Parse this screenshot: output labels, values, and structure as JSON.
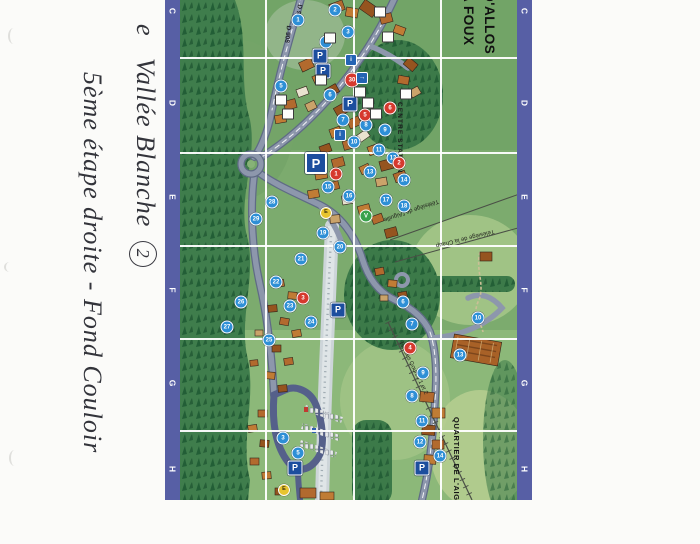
{
  "note": {
    "fragment": "e",
    "line1_prefix": "e",
    "line1_text": "Vallée Blanche",
    "line1_badge": "2",
    "line2_text": "5ème étape droite - Fond Couloir"
  },
  "map": {
    "title_line1": "D'ALLOS",
    "title_line2": "A FOUX",
    "grid_rows": [
      "C",
      "D",
      "E",
      "F",
      "G",
      "H"
    ],
    "road_label": "D 908",
    "labels": {
      "centre_station": "CENTRE STATION",
      "quartier_aiguille": "QUARTIER DE L'AIGUILLE",
      "lift_aiguille": "Télésiège de l'Aiguille",
      "lift_chaup": "Télésiège de la Chaup",
      "lift_goures": "Tsd des Gourès 1 et 2"
    },
    "colors": {
      "grid_strip": "#575fa5",
      "grid_line": "#ffffff",
      "meadow": "#7cab6e",
      "forest": "#2f6b3f",
      "road": "#8d97ac",
      "river": "#cdd5d9",
      "roof": "#b26a2e",
      "marker_blue": "#2e8fd6",
      "marker_red": "#d6392e",
      "parking_blue": "#1d4e9e"
    },
    "markers": [
      {
        "t": "p",
        "x": 140,
        "y": 56
      },
      {
        "t": "p",
        "x": 143,
        "y": 71
      },
      {
        "t": "pbig",
        "x": 136,
        "y": 163
      },
      {
        "t": "p",
        "x": 170,
        "y": 104
      },
      {
        "t": "p",
        "x": 158,
        "y": 310
      },
      {
        "t": "p",
        "x": 115,
        "y": 468
      },
      {
        "t": "p",
        "x": 242,
        "y": 468
      },
      {
        "t": "s30",
        "n": "30",
        "x": 172,
        "y": 80
      },
      {
        "t": "n",
        "n": "1",
        "x": 118,
        "y": 20
      },
      {
        "t": "n",
        "n": "2",
        "x": 155,
        "y": 10
      },
      {
        "t": "n",
        "n": "3",
        "x": 168,
        "y": 32
      },
      {
        "t": "n",
        "n": "4",
        "x": 146,
        "y": 42
      },
      {
        "t": "n",
        "n": "5",
        "x": 101,
        "y": 86
      },
      {
        "t": "n",
        "n": "6",
        "x": 150,
        "y": 95
      },
      {
        "t": "n",
        "n": "7",
        "x": 163,
        "y": 120
      },
      {
        "t": "n",
        "n": "8",
        "x": 186,
        "y": 125
      },
      {
        "t": "n",
        "n": "9",
        "x": 205,
        "y": 130
      },
      {
        "t": "n",
        "n": "10",
        "x": 174,
        "y": 142
      },
      {
        "t": "n",
        "n": "11",
        "x": 199,
        "y": 150
      },
      {
        "t": "n",
        "n": "12",
        "x": 213,
        "y": 158
      },
      {
        "t": "n",
        "n": "13",
        "x": 190,
        "y": 172
      },
      {
        "t": "n",
        "n": "14",
        "x": 224,
        "y": 180
      },
      {
        "t": "n",
        "n": "15",
        "x": 148,
        "y": 187
      },
      {
        "t": "n",
        "n": "16",
        "x": 169,
        "y": 196
      },
      {
        "t": "n",
        "n": "17",
        "x": 206,
        "y": 200
      },
      {
        "t": "n",
        "n": "18",
        "x": 224,
        "y": 206
      },
      {
        "t": "n",
        "n": "19",
        "x": 143,
        "y": 233
      },
      {
        "t": "n",
        "n": "20",
        "x": 160,
        "y": 247
      },
      {
        "t": "n",
        "n": "21",
        "x": 121,
        "y": 259
      },
      {
        "t": "n",
        "n": "22",
        "x": 96,
        "y": 282
      },
      {
        "t": "n",
        "n": "23",
        "x": 110,
        "y": 306
      },
      {
        "t": "n",
        "n": "24",
        "x": 131,
        "y": 322
      },
      {
        "t": "n",
        "n": "25",
        "x": 89,
        "y": 340
      },
      {
        "t": "n",
        "n": "26",
        "x": 61,
        "y": 302
      },
      {
        "t": "n",
        "n": "27",
        "x": 47,
        "y": 327
      },
      {
        "t": "n",
        "n": "28",
        "x": 92,
        "y": 202
      },
      {
        "t": "n",
        "n": "29",
        "x": 76,
        "y": 219
      },
      {
        "t": "n",
        "n": "6",
        "x": 223,
        "y": 302
      },
      {
        "t": "n",
        "n": "7",
        "x": 232,
        "y": 324
      },
      {
        "t": "n",
        "n": "10",
        "x": 298,
        "y": 318
      },
      {
        "t": "n",
        "n": "13",
        "x": 280,
        "y": 355
      },
      {
        "t": "n",
        "n": "9",
        "x": 243,
        "y": 373
      },
      {
        "t": "n",
        "n": "8",
        "x": 232,
        "y": 396
      },
      {
        "t": "n",
        "n": "11",
        "x": 242,
        "y": 421
      },
      {
        "t": "n",
        "n": "12",
        "x": 240,
        "y": 442
      },
      {
        "t": "n",
        "n": "14",
        "x": 260,
        "y": 456
      },
      {
        "t": "n",
        "n": "3",
        "x": 103,
        "y": 438
      },
      {
        "t": "n",
        "n": "5",
        "x": 118,
        "y": 453
      },
      {
        "t": "r",
        "n": "1",
        "x": 156,
        "y": 174
      },
      {
        "t": "r",
        "n": "2",
        "x": 219,
        "y": 163
      },
      {
        "t": "r",
        "n": "3",
        "x": 123,
        "y": 298
      },
      {
        "t": "r",
        "n": "4",
        "x": 230,
        "y": 348
      },
      {
        "t": "r",
        "n": "5",
        "x": 185,
        "y": 115
      },
      {
        "t": "r",
        "n": "6",
        "x": 210,
        "y": 108
      },
      {
        "t": "y",
        "n": "E",
        "x": 146,
        "y": 213
      },
      {
        "t": "y",
        "n": "E",
        "x": 104,
        "y": 490
      },
      {
        "t": "g",
        "n": "V",
        "x": 186,
        "y": 216
      },
      {
        "t": "ws",
        "x": 101,
        "y": 100
      },
      {
        "t": "ws",
        "x": 108,
        "y": 114
      },
      {
        "t": "ws",
        "x": 141,
        "y": 80
      },
      {
        "t": "ws",
        "x": 180,
        "y": 92
      },
      {
        "t": "ws",
        "x": 188,
        "y": 103
      },
      {
        "t": "ws",
        "x": 196,
        "y": 114
      },
      {
        "t": "ws",
        "x": 150,
        "y": 38
      },
      {
        "t": "ws",
        "x": 200,
        "y": 12
      },
      {
        "t": "ws",
        "x": 226,
        "y": 94
      },
      {
        "t": "ws",
        "x": 208,
        "y": 37
      },
      {
        "t": "bs",
        "n": "i",
        "x": 171,
        "y": 60
      },
      {
        "t": "bs",
        "n": "→",
        "x": 182,
        "y": 78
      },
      {
        "t": "bs",
        "n": "i",
        "x": 160,
        "y": 135
      }
    ]
  }
}
